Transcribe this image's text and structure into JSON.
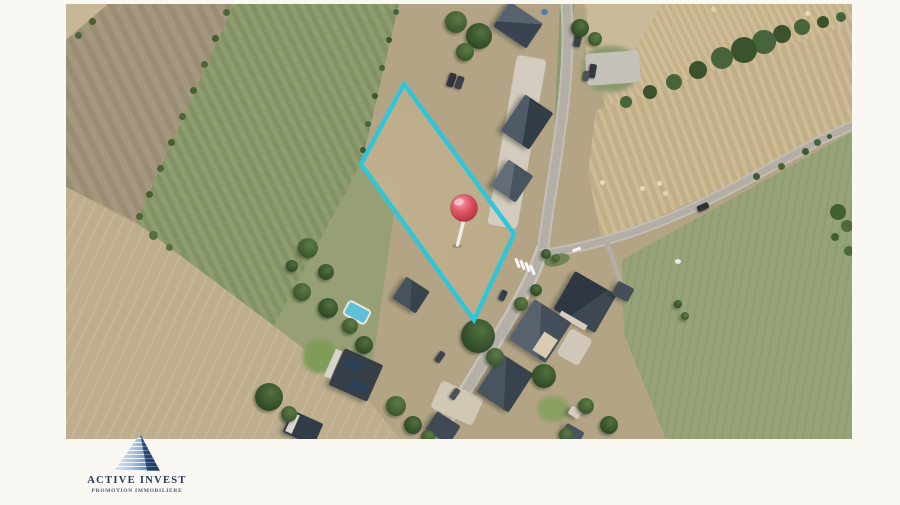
{
  "page": {
    "background": "#faf8f2"
  },
  "logo": {
    "name": "ACTIVE INVEST",
    "tagline": "PROMOTION IMMOBILIERE",
    "icon": "building-peak-icon",
    "name_color": "#26395c",
    "tagline_color": "#46597c"
  },
  "map": {
    "type": "aerial-photo",
    "boundary_color": "#2cc7db",
    "boundary_points": "338,80 448,230 408,316 295,160",
    "pin": {
      "x": 398,
      "y": 204,
      "r": 13.5,
      "color": "#e25565",
      "stick": "M397.5,216 C396,225 393.5,233 391.5,241"
    }
  }
}
